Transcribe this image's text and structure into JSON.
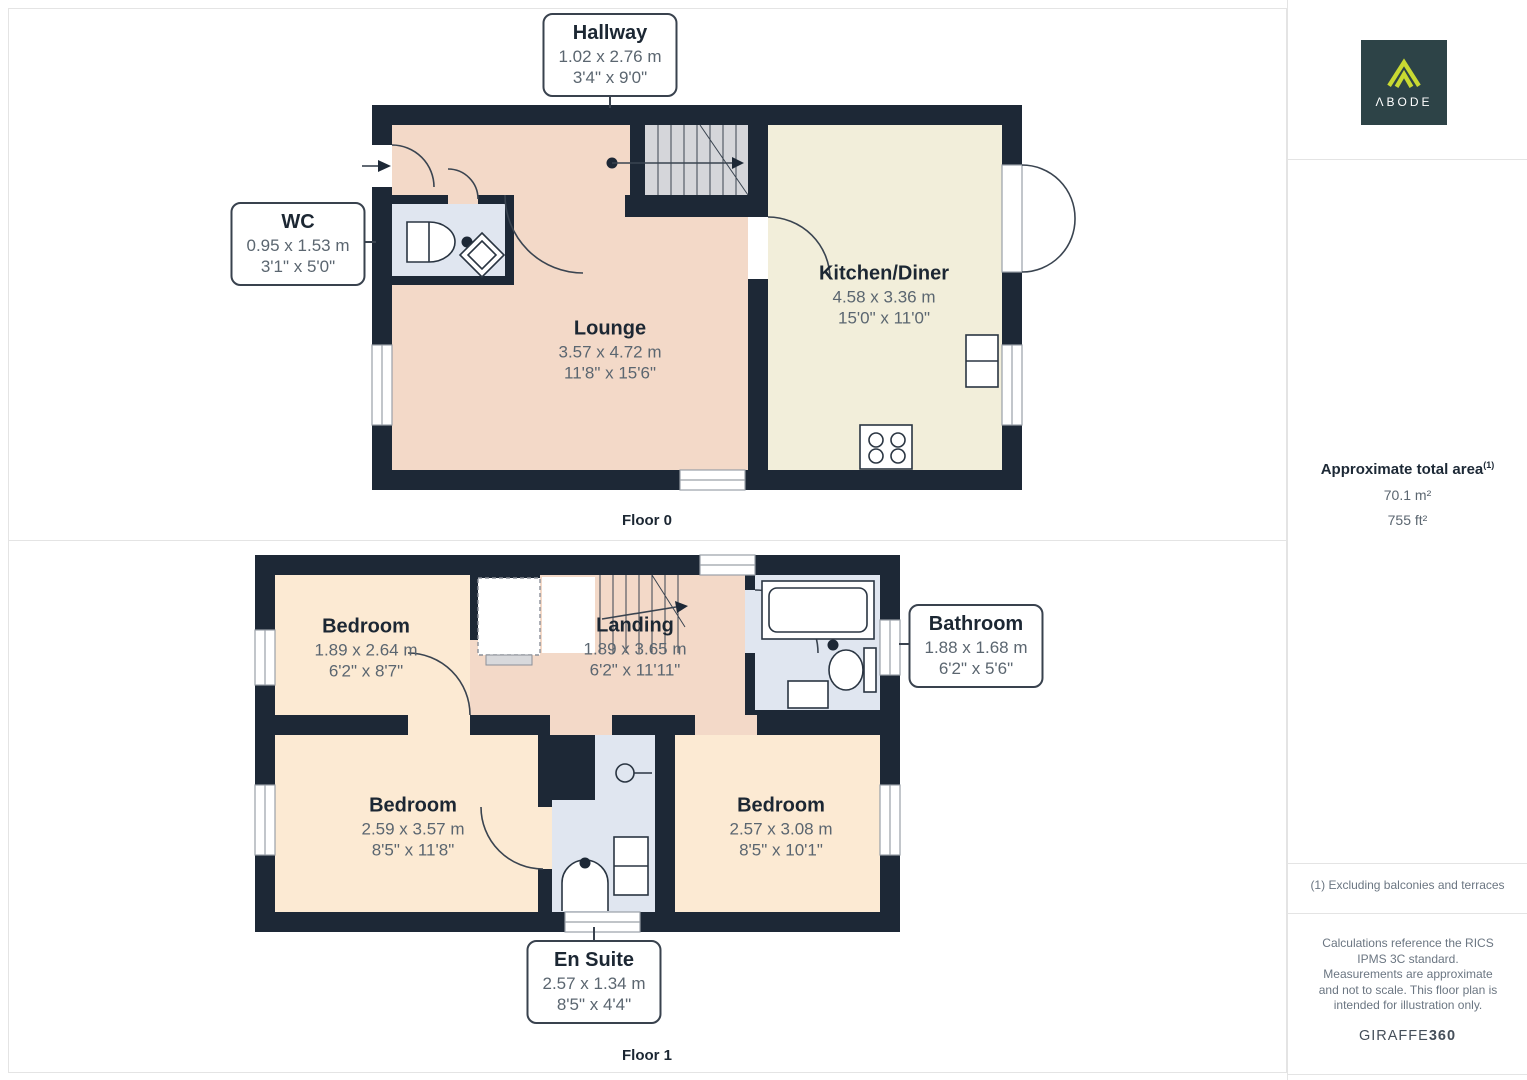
{
  "branding": {
    "logo_text": "ΛBODE"
  },
  "floor0": {
    "label": "Floor 0",
    "rooms": [
      {
        "name": "Lounge",
        "metric": "3.57 x 4.72 m",
        "imperial": "11'8\" x 15'6\""
      },
      {
        "name": "Kitchen/Diner",
        "metric": "4.58 x 3.36 m",
        "imperial": "15'0\" x 11'0\""
      }
    ],
    "callouts": [
      {
        "name": "Hallway",
        "metric": "1.02 x 2.76 m",
        "imperial": "3'4\" x 9'0\""
      },
      {
        "name": "WC",
        "metric": "0.95 x 1.53 m",
        "imperial": "3'1\" x 5'0\""
      }
    ]
  },
  "floor1": {
    "label": "Floor 1",
    "rooms": [
      {
        "name": "Bedroom",
        "metric": "1.89 x 2.64 m",
        "imperial": "6'2\" x 8'7\""
      },
      {
        "name": "Landing",
        "metric": "1.89 x 3.65 m",
        "imperial": "6'2\" x 11'11\""
      },
      {
        "name": "Bedroom",
        "metric": "2.59 x 3.57 m",
        "imperial": "8'5\" x 11'8\""
      },
      {
        "name": "Bedroom",
        "metric": "2.57 x 3.08 m",
        "imperial": "8'5\" x 10'1\""
      }
    ],
    "callouts": [
      {
        "name": "Bathroom",
        "metric": "1.88 x 1.68 m",
        "imperial": "6'2\" x 5'6\""
      },
      {
        "name": "En Suite",
        "metric": "2.57 x 1.34 m",
        "imperial": "8'5\" x 4'4\""
      }
    ]
  },
  "sidebar": {
    "area_title": "Approximate total area",
    "area_superscript": "(1)",
    "area_m2": "70.1 m²",
    "area_ft2": "755 ft²",
    "footnote": "(1) Excluding balconies and terraces",
    "disclaimer": "Calculations reference the RICS IPMS 3C standard. Measurements are approximate and not to scale. This floor plan is intended for illustration only.",
    "brand_giraffe": "GIRAFFE",
    "brand_360": "360"
  },
  "colors": {
    "wall": "#1d2836",
    "lounge": "#f3d9c8",
    "kitchen": "#f2eeda",
    "bedroom": "#fcead3",
    "wet": "#e0e6f0",
    "stairs": "#d5d6da",
    "accent_logo": "#c9d932",
    "logo_bg": "#2d4347"
  }
}
